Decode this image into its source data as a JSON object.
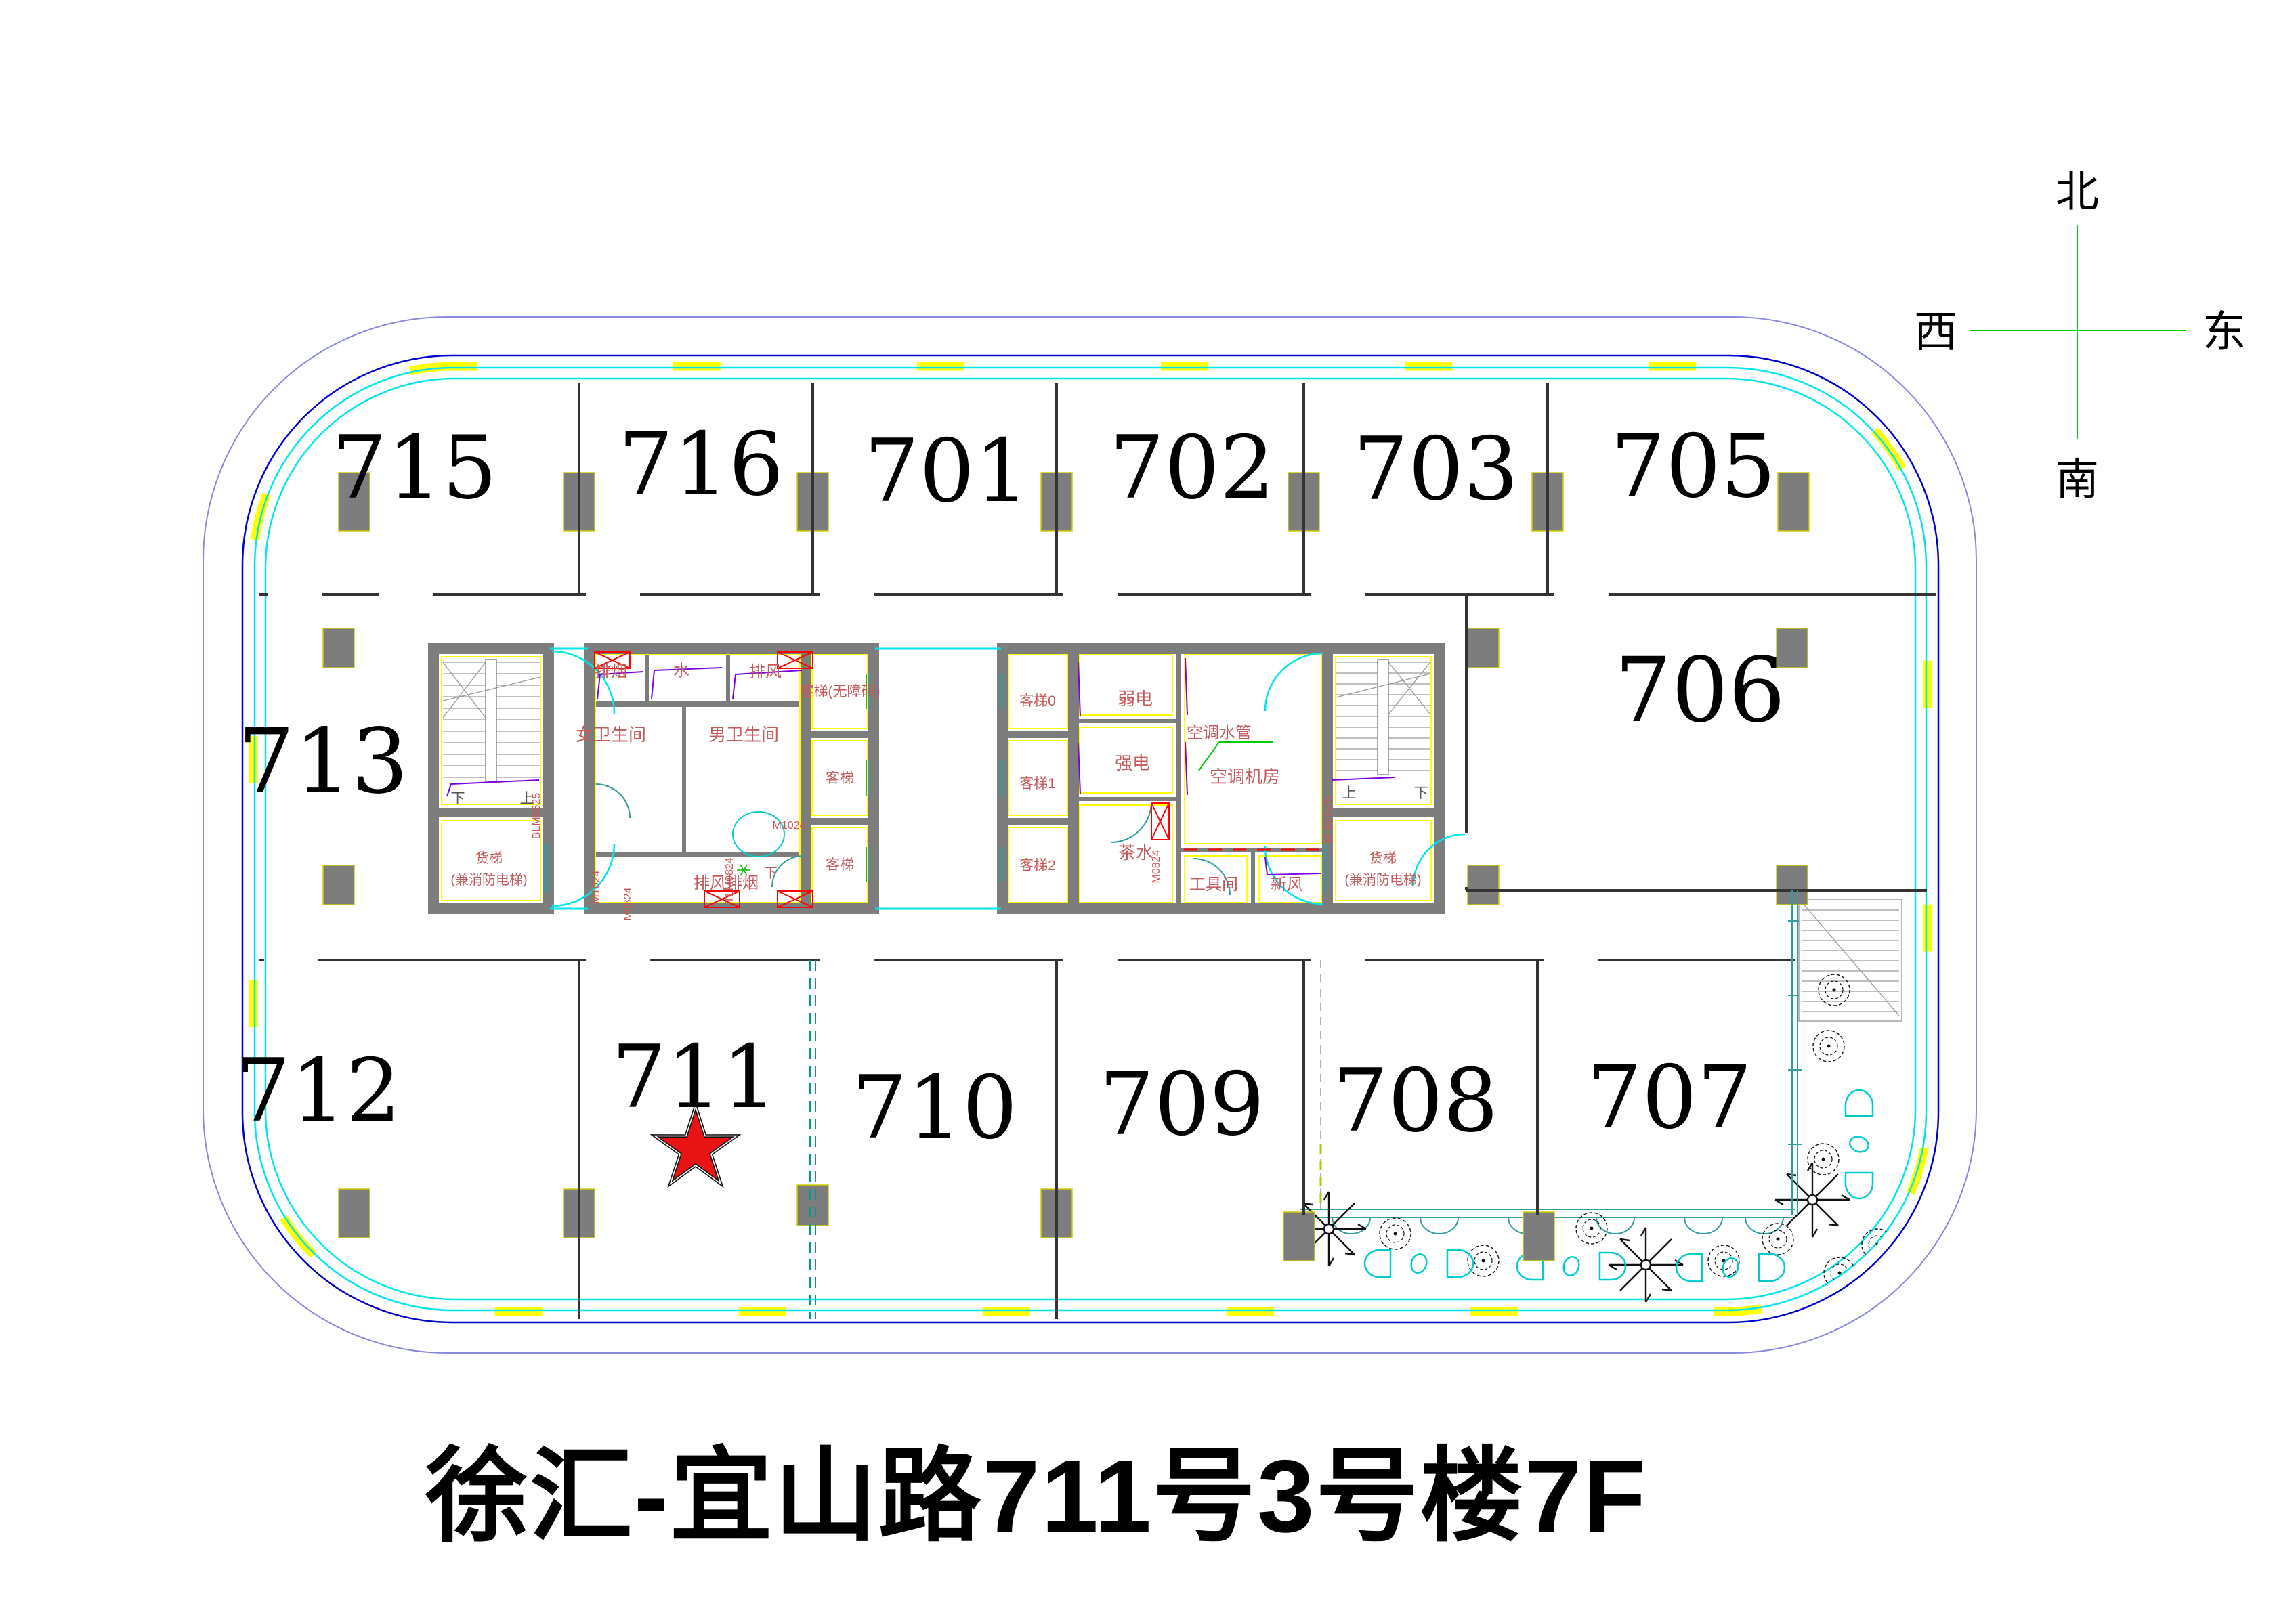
{
  "title": "徐汇-宜山路711号3号楼7F",
  "compass": {
    "north": "北",
    "south": "南",
    "west": "西",
    "east": "东"
  },
  "rooms": {
    "top": [
      "715",
      "716",
      "701",
      "702",
      "703",
      "705"
    ],
    "middle_left": "713",
    "middle_right": "706",
    "bottom": [
      "712",
      "711",
      "710",
      "709",
      "708",
      "707"
    ]
  },
  "core": {
    "shafts": {
      "smoke_exhaust": "排烟",
      "water": "水",
      "air_exhaust": "排风",
      "air_smoke_exhaust": "排风排烟"
    },
    "toilets": {
      "female": "女卫生间",
      "male": "男卫生间"
    },
    "elevators": {
      "bank1": [
        "客梯(无障碍)",
        "客梯",
        "客梯"
      ],
      "bank2": [
        "客梯0",
        "客梯1",
        "客梯2"
      ],
      "freight_line1": "货梯",
      "freight_line2": "(兼消防电梯)"
    },
    "service_rooms": {
      "weak_power": "弱电",
      "strong_power": "强电",
      "pantry": "茶水",
      "ac_pipe_label": "空调水管",
      "ac_plant_room": "空调机房",
      "tool_room": "工具间",
      "fresh_air": "新风"
    },
    "stairs": {
      "up": "上",
      "down": "下"
    }
  },
  "door_tags": {
    "blm0525": "BLM0525",
    "m1024": "M1024",
    "m0824": "M0824",
    "tlm0824": "TLM0824"
  },
  "marker": {
    "starred_room": "711"
  },
  "colors": {
    "facade_blue": "#0000CC",
    "curtain_cyan": "#00DDE6",
    "mullion_yellow": "#FFFF00",
    "outer_line": "#8888DD",
    "core_wall_gray": "#7D7D7D",
    "label_red": "#C65A5A",
    "damper_red": "#FF0000",
    "star_red": "#E81313",
    "compass_green": "#00CC00",
    "pipe_purple": "#7A00E6",
    "door_teal": "#2E9E9E"
  }
}
